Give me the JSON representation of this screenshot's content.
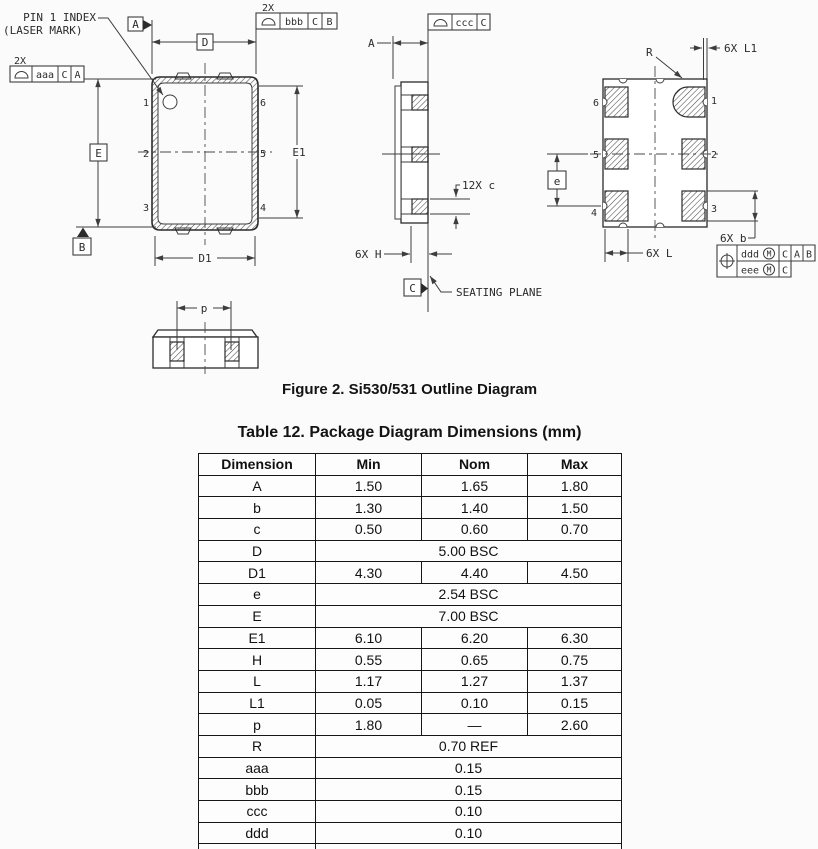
{
  "figure": {
    "caption": "Figure 2. Si530/531 Outline Diagram",
    "top_view": {
      "pin1_index_line1": "PIN 1 INDEX",
      "pin1_index_line2": "(LASER MARK)",
      "qty_2x_aaa": "2X",
      "fcf_aaa": {
        "tol": "aaa",
        "d1": "C",
        "d2": "A"
      },
      "qty_2x_bbb": "2X",
      "fcf_bbb": {
        "tol": "bbb",
        "d1": "C",
        "d2": "B"
      },
      "datum_a": "A",
      "datum_b": "B",
      "dim_d": "D",
      "dim_d1": "D1",
      "dim_e": "E",
      "dim_e1": "E1",
      "pin_labels": {
        "p1": "1",
        "p2": "2",
        "p3": "3",
        "p4": "4",
        "p5": "5",
        "p6": "6"
      }
    },
    "side_view": {
      "dim_a": "A",
      "fcf_ccc": {
        "tol": "ccc",
        "d1": "C"
      },
      "dim_c": "12X c",
      "dim_h": "6X H",
      "datum_c": "C",
      "seating_plane": "SEATING PLANE"
    },
    "bottom_view": {
      "dim_r": "R",
      "dim_l1": "6X L1",
      "dim_e": "e",
      "dim_l": "6X L",
      "dim_b": "6X b",
      "fcf_position": {
        "tol1": "ddd",
        "mod1": "M",
        "d1a": "C",
        "d1b": "A",
        "d1c": "B",
        "tol2": "eee",
        "mod2": "M",
        "d2a": "C"
      },
      "pin_labels": {
        "p1": "1",
        "p2": "2",
        "p3": "3",
        "p4": "4",
        "p5": "5",
        "p6": "6"
      }
    },
    "detail_view": {
      "dim_p": "p"
    }
  },
  "table": {
    "title": "Table 12. Package Diagram Dimensions (mm)",
    "headers": [
      "Dimension",
      "Min",
      "Nom",
      "Max"
    ],
    "rows": [
      {
        "dim": "A",
        "min": "1.50",
        "nom": "1.65",
        "max": "1.80"
      },
      {
        "dim": "b",
        "min": "1.30",
        "nom": "1.40",
        "max": "1.50"
      },
      {
        "dim": "c",
        "min": "0.50",
        "nom": "0.60",
        "max": "0.70"
      },
      {
        "dim": "D",
        "span": "5.00 BSC"
      },
      {
        "dim": "D1",
        "min": "4.30",
        "nom": "4.40",
        "max": "4.50"
      },
      {
        "dim": "e",
        "span": "2.54 BSC"
      },
      {
        "dim": "E",
        "span": "7.00 BSC"
      },
      {
        "dim": "E1",
        "min": "6.10",
        "nom": "6.20",
        "max": "6.30"
      },
      {
        "dim": "H",
        "min": "0.55",
        "nom": "0.65",
        "max": "0.75"
      },
      {
        "dim": "L",
        "min": "1.17",
        "nom": "1.27",
        "max": "1.37"
      },
      {
        "dim": "L1",
        "min": "0.05",
        "nom": "0.10",
        "max": "0.15"
      },
      {
        "dim": "p",
        "min": "1.80",
        "nom": "—",
        "max": "2.60"
      },
      {
        "dim": "R",
        "span": "0.70 REF"
      },
      {
        "dim": "aaa",
        "span": "0.15"
      },
      {
        "dim": "bbb",
        "span": "0.15"
      },
      {
        "dim": "ccc",
        "span": "0.10"
      },
      {
        "dim": "ddd",
        "span": "0.10"
      },
      {
        "dim": "eee",
        "span": "0.05"
      }
    ]
  }
}
